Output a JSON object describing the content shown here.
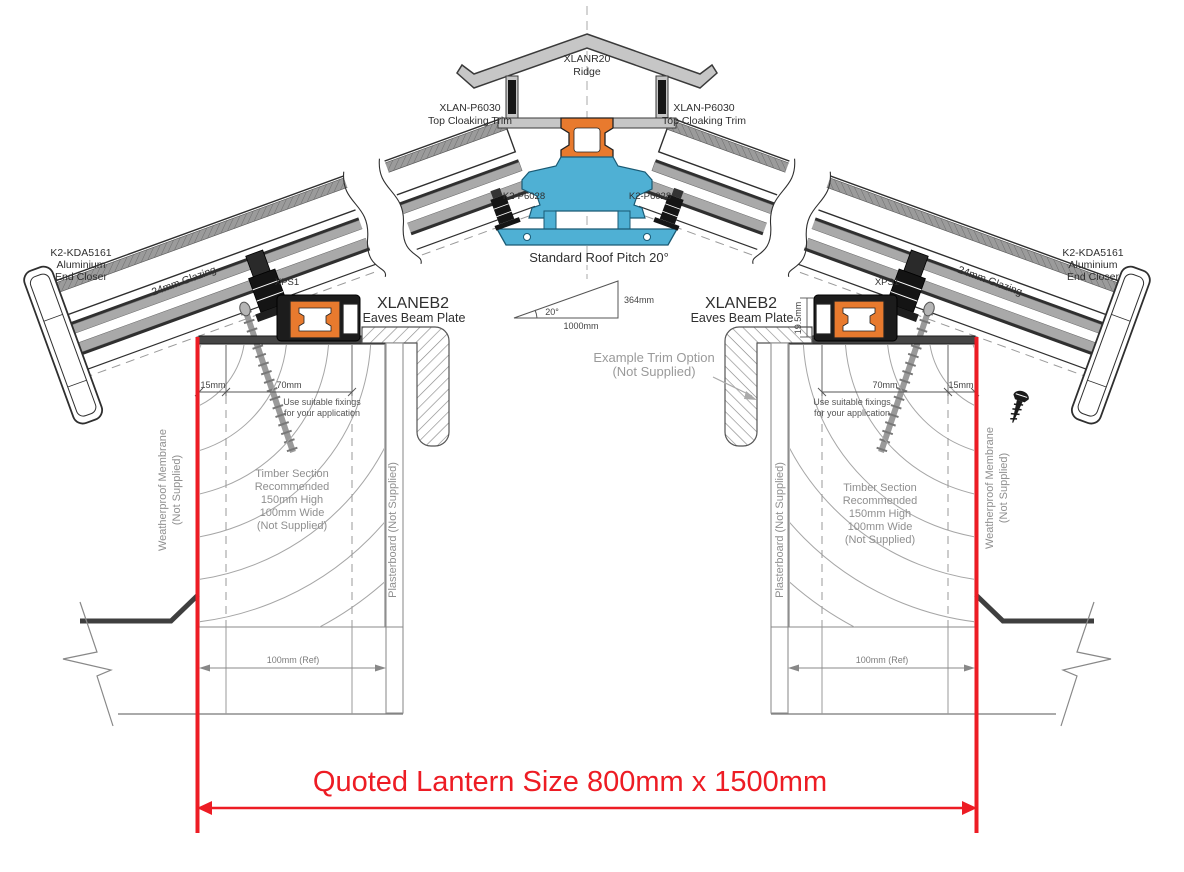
{
  "labels": {
    "ridge_code": "XLANR20",
    "ridge_name": "Ridge",
    "cloaking_code": "XLAN-P6030",
    "cloaking_name": "Top Cloaking Trim",
    "k2p6028": "K2-P6028",
    "pitch_title": "Standard Roof Pitch 20°",
    "pitch_rise": "364mm",
    "pitch_angle": "20°",
    "pitch_run": "1000mm",
    "end_closer_code": "K2-KDA5161",
    "end_closer_l1": "Aluminium",
    "end_closer_l2": "End Closer",
    "glazing": "24mm Glazing",
    "xps": "XPS1",
    "eaves_code": "XLANEB2",
    "eaves_name": "Eaves Beam Plate",
    "trim_option_l1": "Example  Trim Option",
    "trim_option_l2": "(Not Supplied)",
    "dim_15": "15mm",
    "dim_70": "70mm",
    "dim_upstand": "19.5mm",
    "fixings_l1": "Use suitable fixings",
    "fixings_l2": "for your application",
    "timber_l1": "Timber Section",
    "timber_l2": "Recommended",
    "timber_l3": "150mm High",
    "timber_l4": "100mm Wide",
    "timber_l5": "(Not Supplied)",
    "membrane_l1": "Weatherproof Membrane",
    "membrane_l2": "(Not Supplied)",
    "plasterboard": "Plasterboard (Not Supplied)",
    "dim_100_ref": "100mm (Ref)",
    "quoted_size": "Quoted Lantern Size 800mm x 1500mm"
  },
  "colors": {
    "red": "#ED1C24",
    "orange": "#E87A2E",
    "blue": "#4FB0D4",
    "capgray": "#C6C6C6"
  }
}
